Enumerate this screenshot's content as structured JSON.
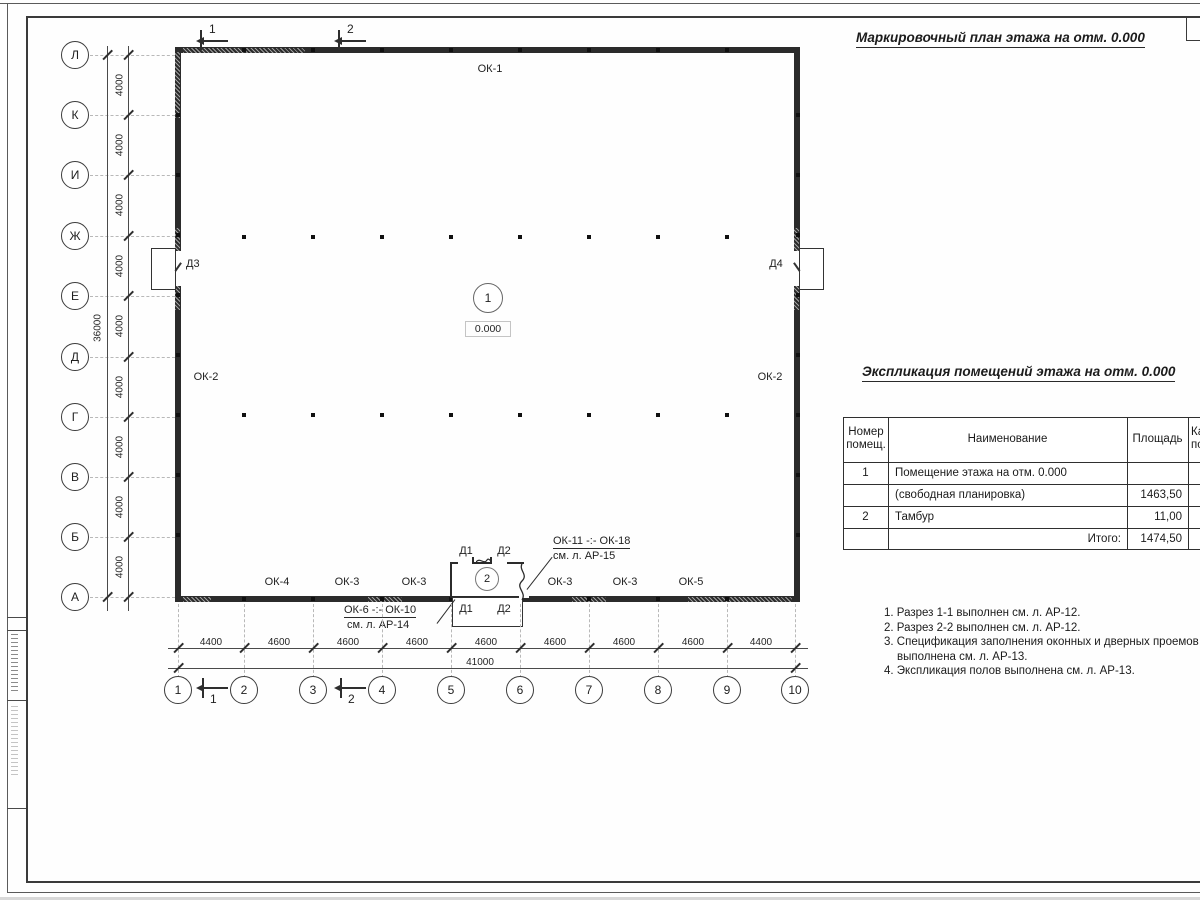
{
  "plan_title": "Маркировочный план этажа на отм. 0.000",
  "table_title": "Экспликация помещений этажа на отм. 0.000",
  "axes": {
    "rows": [
      "Л",
      "К",
      "И",
      "Ж",
      "Е",
      "Д",
      "Г",
      "В",
      "Б",
      "А"
    ],
    "cols": [
      "1",
      "2",
      "3",
      "4",
      "5",
      "6",
      "7",
      "8",
      "9",
      "10"
    ]
  },
  "dims": {
    "v": [
      "4000",
      "4000",
      "4000",
      "4000",
      "4000",
      "4000",
      "4000",
      "4000",
      "4000"
    ],
    "v_total": "36000",
    "h": [
      "4400",
      "4600",
      "4600",
      "4600",
      "4600",
      "4600",
      "4600",
      "4600",
      "4400"
    ],
    "h_total": "41000"
  },
  "marks": {
    "section_1": "1",
    "section_2": "2"
  },
  "plan_labels": {
    "ok1": "ОК-1",
    "ok2_left": "ОК-2",
    "ok2_right": "ОК-2",
    "ok4": "ОК-4",
    "ok3_a": "ОК-3",
    "ok3_b": "ОК-3",
    "ok3_c": "ОК-3",
    "ok3_d": "ОК-3",
    "ok5": "ОК-5",
    "d1": "Д1",
    "d2": "Д2",
    "d3": "Д3",
    "d4": "Д4",
    "room1_num": "1",
    "room1_level": "0.000",
    "room2_num": "2",
    "leader_right_1": "ОК-11 -:- ОК-18",
    "leader_right_2": "см. л. АР-15",
    "leader_left_1": "ОК-6 -:- ОК-10",
    "leader_left_2": "см. л. АР-14"
  },
  "table": {
    "headers": {
      "num": "Номер помещ.",
      "name": "Наименование",
      "area": "Площадь",
      "cut": "Ка по"
    },
    "rows": [
      {
        "num": "1",
        "name": "Помещение этажа на отм. 0.000",
        "area": ""
      },
      {
        "num": "",
        "name": "(свободная планировка)",
        "area": "1463,50"
      },
      {
        "num": "2",
        "name": "Тамбур",
        "area": "11,00"
      },
      {
        "num": "",
        "name": "Итого:",
        "area": "1474,50"
      }
    ]
  },
  "notes": [
    "1. Разрез 1-1 выполнен см. л. АР-12.",
    "2. Разрез 2-2 выполнен см. л. АР-12.",
    "3. Спецификация заполнения оконных и дверных проемов выполнена см. л. АР-13.",
    "4. Экспликация полов выполнена см. л. АР-13."
  ],
  "colors": {
    "line": "#2e2e2e",
    "text": "#1f1f1f",
    "light_line": "#b8b8b8"
  }
}
